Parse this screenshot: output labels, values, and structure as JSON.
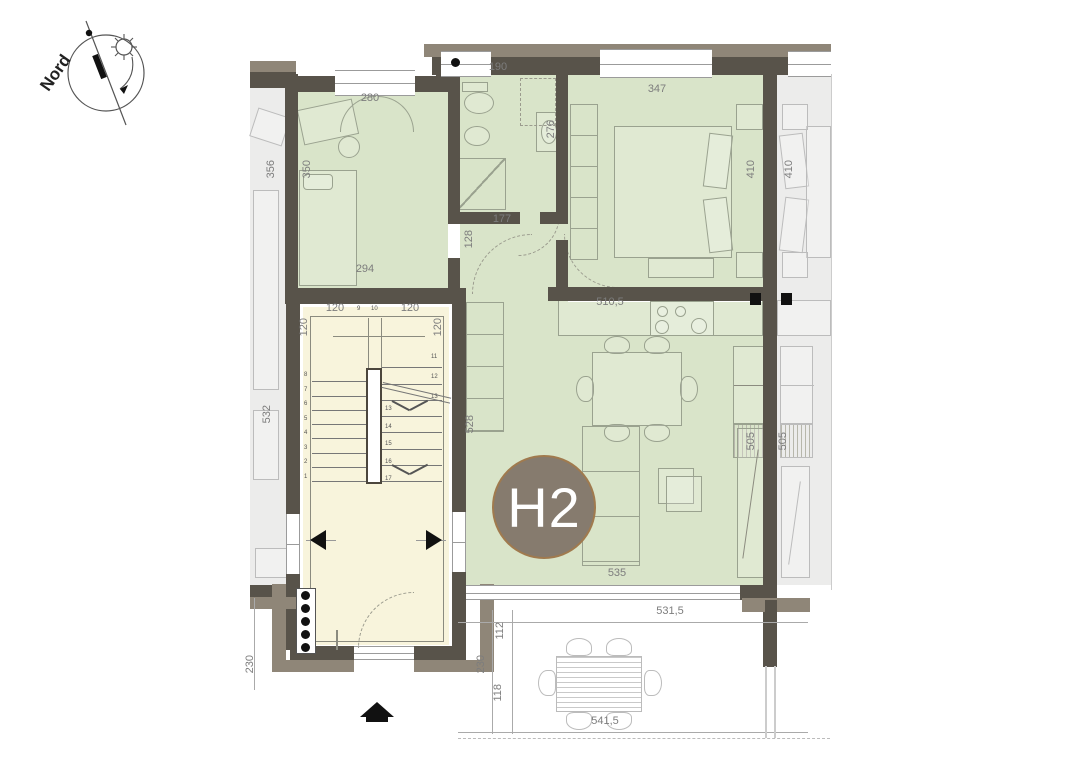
{
  "compass": {
    "label": "Nord"
  },
  "unit_badge": {
    "label": "H2",
    "bg": "#867b6e",
    "rim": "#a07a4e"
  },
  "colors": {
    "wall": "#58534a",
    "wall_outer": "#8f8678",
    "floor_unit_green": "#d9e4c9",
    "floor_stairwell_cream": "#f8f4dc",
    "floor_neighbor_grey": "#ececeb",
    "dimension_text": "#7d7d7d"
  },
  "dims": {
    "bedroom_window": "280",
    "bedroom_height": "350",
    "neighbor_left_bedroom": "356",
    "bedroom_width": "294",
    "bath_width": "190",
    "bath_basin": "276",
    "hall_width": "177",
    "hall_height": "128",
    "master_window": "347",
    "master_height": "410",
    "neighbor_right_bedroom": "410",
    "kitchen_width": "510,5",
    "living_height": "528",
    "living_right": "505",
    "neighbor_right_living": "505",
    "living_width": "535",
    "neighbor_left_living": "532",
    "stair_top_left": "120",
    "stair_top_right": "120",
    "stair_left": "120",
    "stair_right": "120",
    "terrace_width": "531,5",
    "terrace_offset_top": "112",
    "terrace_depth": "230",
    "terrace_offset_bottom": "118",
    "terrace_bottom_width": "541,5",
    "porch_left_depth": "230"
  },
  "stairs": {
    "left_flight": [
      "8",
      "7",
      "6",
      "5",
      "4",
      "3",
      "2",
      "1"
    ],
    "top": [
      "9",
      "10"
    ],
    "right_side": [
      "11",
      "12",
      "13"
    ],
    "center": [
      "13",
      "14",
      "15",
      "16",
      "17"
    ]
  }
}
